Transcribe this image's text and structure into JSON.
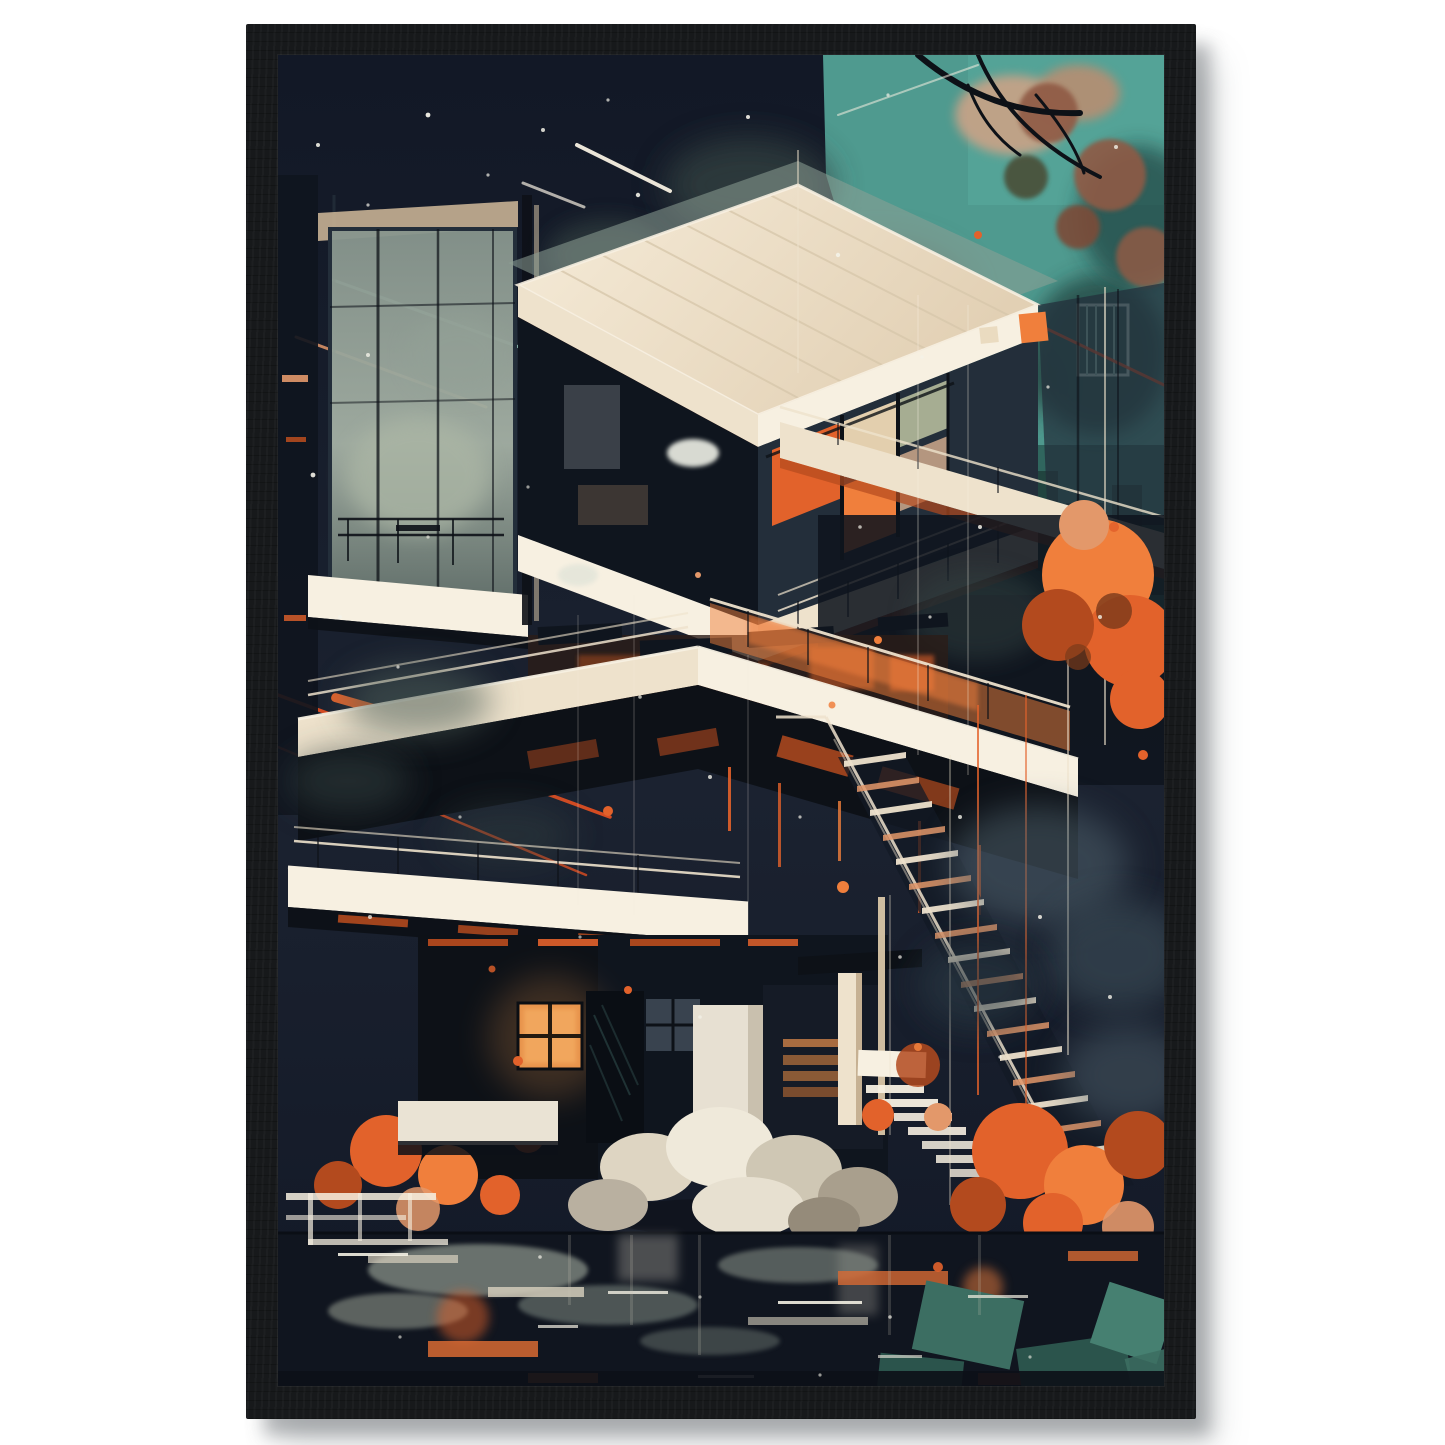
{
  "poster": {
    "alt_text": "Black-framed art print of a futuristic modernist house at night with orange foliage, long staircase and water reflections",
    "palette": {
      "wall": "#ffffff",
      "frame": "#17191b",
      "frame_grain": "#24272a",
      "shadow": "rgba(104,108,112,0.45)",
      "navy": "#1b2230",
      "navy_deep": "#121826",
      "teal_sky": "#4f9a8f",
      "teal_mid": "#3b7d74",
      "teal_deep": "#2a5d56",
      "skyline": "#20413c",
      "smoke": "#4e5e59",
      "smoke_dark": "#323f41",
      "smoke_light": "#97a398",
      "cream": "#eee2cc",
      "cream_warm": "#e3cfae",
      "cream_shadow": "#c6b193",
      "white_warm": "#f7f0e1",
      "concrete": "#b3ad9c",
      "orange": "#e2622b",
      "orange_bright": "#f07f3c",
      "orange_deep": "#b34a1e",
      "salmon": "#e3986a",
      "rust": "#8f5a44",
      "peach": "#c4a287",
      "sage": "#a6ad92",
      "glass_dark": "#0f151e",
      "glass_mid": "#232e3a",
      "glass_light": "#71807c",
      "slate": "#536671",
      "water_teal": "#3c6e62",
      "water_teal_deep": "#2b544c",
      "ink": "#0d1117",
      "line_red": "#e04f22",
      "glow_window": "#e8944c"
    }
  }
}
